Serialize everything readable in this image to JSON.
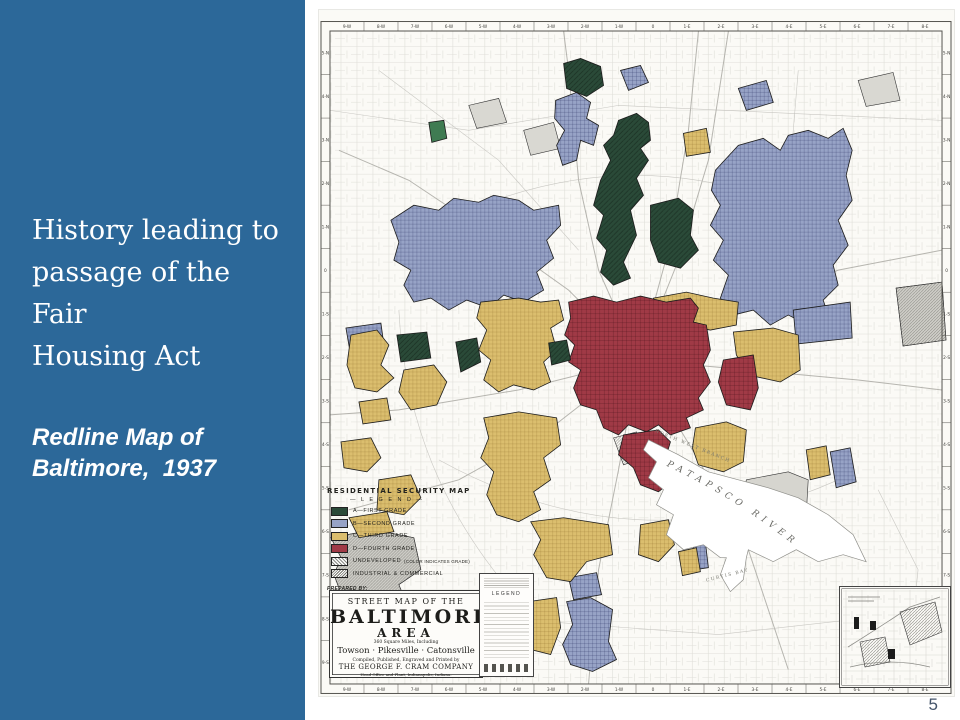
{
  "slide": {
    "title": "History leading to\npassage of the Fair\nHousing Act",
    "subtitle": "Redline Map of\nBaltimore,  1937",
    "page_number": "5"
  },
  "colors": {
    "sidebar_blue": "#2C6899",
    "page_number_color": "#44546A",
    "map_paper": "#FAF9F5",
    "grade_a_green": "#2A4A38",
    "grade_b_blue": "#97A3C6",
    "grade_c_yellow": "#DBBE6E",
    "grade_d_red": "#A03A46",
    "industrial_gray": "#C8C7C1"
  },
  "map": {
    "legend": {
      "title": "RESIDENTIAL  SECURITY  MAP",
      "subtitle": "— L E G E N D —",
      "items": [
        {
          "grade": "a",
          "label": "A—FIRST GRADE"
        },
        {
          "grade": "b",
          "label": "B—SECOND GRADE"
        },
        {
          "grade": "c",
          "label": "C—THIRD GRADE"
        },
        {
          "grade": "d",
          "label": "D—FOURTH GRADE"
        },
        {
          "grade": "undeveloped",
          "label": "UNDEVELOPED",
          "note": "(COLOR INDICATES GRADE)"
        },
        {
          "grade": "industrial",
          "label": "INDUSTRIAL & COMMERCIAL"
        }
      ],
      "prepared_by": [
        "PREPARED BY:",
        "DIVISION OF RESEARCH & STATISTICS",
        "WITH COOPERATION OF APPRAISAL DEPT.",
        "HOME OWNERS' LOAN CORP. MAY 1, 1937."
      ]
    },
    "title_block": {
      "line1": "STREET MAP OF THE",
      "name": "BALTIMORE",
      "area": "AREA",
      "line2": "360 Square Miles, Including",
      "towns": "Towson · Pikesville · Catonsville",
      "line3": "Compiled, Published, Engraved and Printed by",
      "publisher": "THE GEORGE F. CRAM COMPANY",
      "line4": "Head Office and Plant, Indianapolis, Indiana."
    },
    "labels": {
      "river": "PATAPSCO RIVER",
      "bay": "CURTIS BAY",
      "branch": "NORTH WEST BRANCH"
    },
    "mini_legend_title": "LEGEND",
    "grid_cols": [
      "9-W",
      "8-W",
      "7-W",
      "6-W",
      "5-W",
      "4-W",
      "3-W",
      "2-W",
      "1-W",
      "0",
      "1-E",
      "2-E",
      "3-E",
      "4-E",
      "5-E",
      "6-E",
      "7-E",
      "8-E"
    ],
    "grid_rows": [
      "5-N",
      "4-N",
      "3-N",
      "2-N",
      "1-N",
      "0",
      "1-S",
      "2-S",
      "3-S",
      "4-S",
      "5-S",
      "6-S",
      "7-S",
      "8-S",
      "9-S"
    ]
  }
}
